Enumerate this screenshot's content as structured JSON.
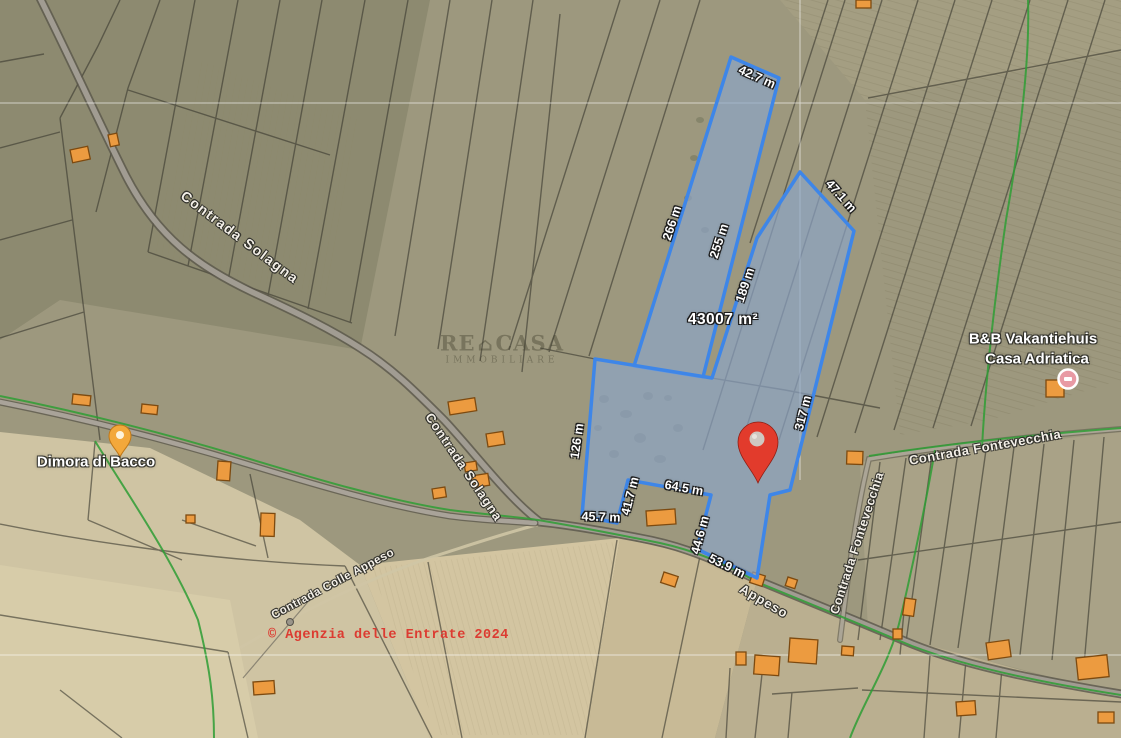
{
  "map": {
    "measurement_labels": [
      {
        "text": "42.7 m"
      },
      {
        "text": "47.1 m"
      },
      {
        "text": "266 m"
      },
      {
        "text": "255 m"
      },
      {
        "text": "189 m"
      },
      {
        "text": "317 m"
      },
      {
        "text": "126 m"
      },
      {
        "text": "45.7 m"
      },
      {
        "text": "41.7 m"
      },
      {
        "text": "64.5 m"
      },
      {
        "text": "44.6 m"
      },
      {
        "text": "53.9 m"
      }
    ],
    "area_label": {
      "text": "43007 m²"
    },
    "road_labels": [
      {
        "text": "Contrada Solagna"
      },
      {
        "text": "Contrada Solagna"
      },
      {
        "text": "Contrada Colle Appeso"
      },
      {
        "text": "Appeso"
      },
      {
        "text": "Contrada Fontevecchia"
      },
      {
        "text": "Contrada Fontevecchia"
      }
    ],
    "place_labels": [
      "Dimora di Bacco",
      "B&B Vakantiehuis",
      "Casa Adriatica"
    ],
    "attribution": "© Agenzia delle Entrate 2024",
    "watermark": {
      "brand_left": "RE",
      "house_glyph": "⌂",
      "brand_right": "CASA",
      "subtitle": "IMMOBILIARE"
    },
    "markers": [
      {
        "name": "property-pin",
        "color": "#e23b2c"
      },
      {
        "name": "poi-pin-yellow",
        "color": "#f3a83b"
      },
      {
        "name": "poi-dot-pink",
        "color": "#e89aa4"
      }
    ],
    "colors": {
      "highlight_fill": "rgba(140,165,200,0.68)",
      "highlight_stroke": "#3e86e8",
      "green_path": "#2f9e35",
      "attribution_red": "#dc3b31"
    }
  }
}
